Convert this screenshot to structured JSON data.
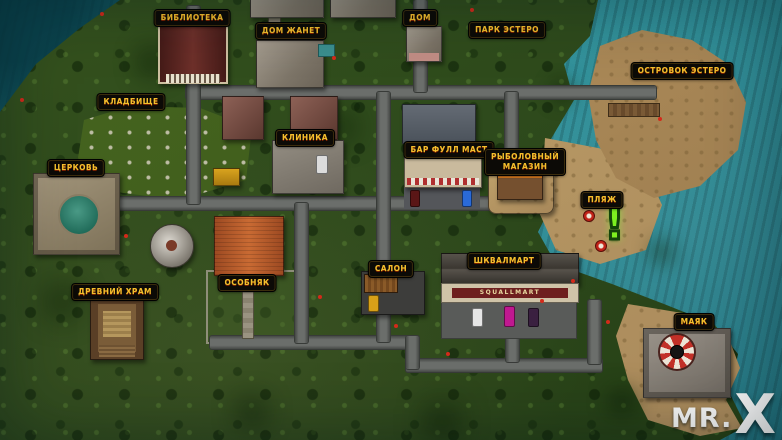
{
  "labels": {
    "library": "Библиотека",
    "janet_house": "Дом Жанет",
    "house": "Дом",
    "park_estero": "Парк Эстеро",
    "estero_islet": "Островок Эстеро",
    "cemetery": "Кладбище",
    "clinic": "Клиника",
    "bar_full_mast": "Бар Фулл Маст",
    "fishing_shop_line1": "Рыболовный",
    "fishing_shop_line2": "магазин",
    "church": "Церковь",
    "beach": "Пляж",
    "mansion": "Особняк",
    "salon": "Салон",
    "squallmart": "Шквалмарт",
    "ancient_temple": "Древний храм",
    "lighthouse": "Маяк"
  },
  "signs": {
    "squallmart_storefront": "SQUALLMART"
  },
  "markers": {
    "quest_exclamation": "!"
  },
  "brand": {
    "mr": "MR.",
    "x": "X"
  },
  "colors": {
    "label_gold": "#f2c12e",
    "quest_green": "#7df020",
    "ocean_teal": "#2a8b92",
    "jungle_green": "#2c481b",
    "sand": "#b7945f"
  }
}
